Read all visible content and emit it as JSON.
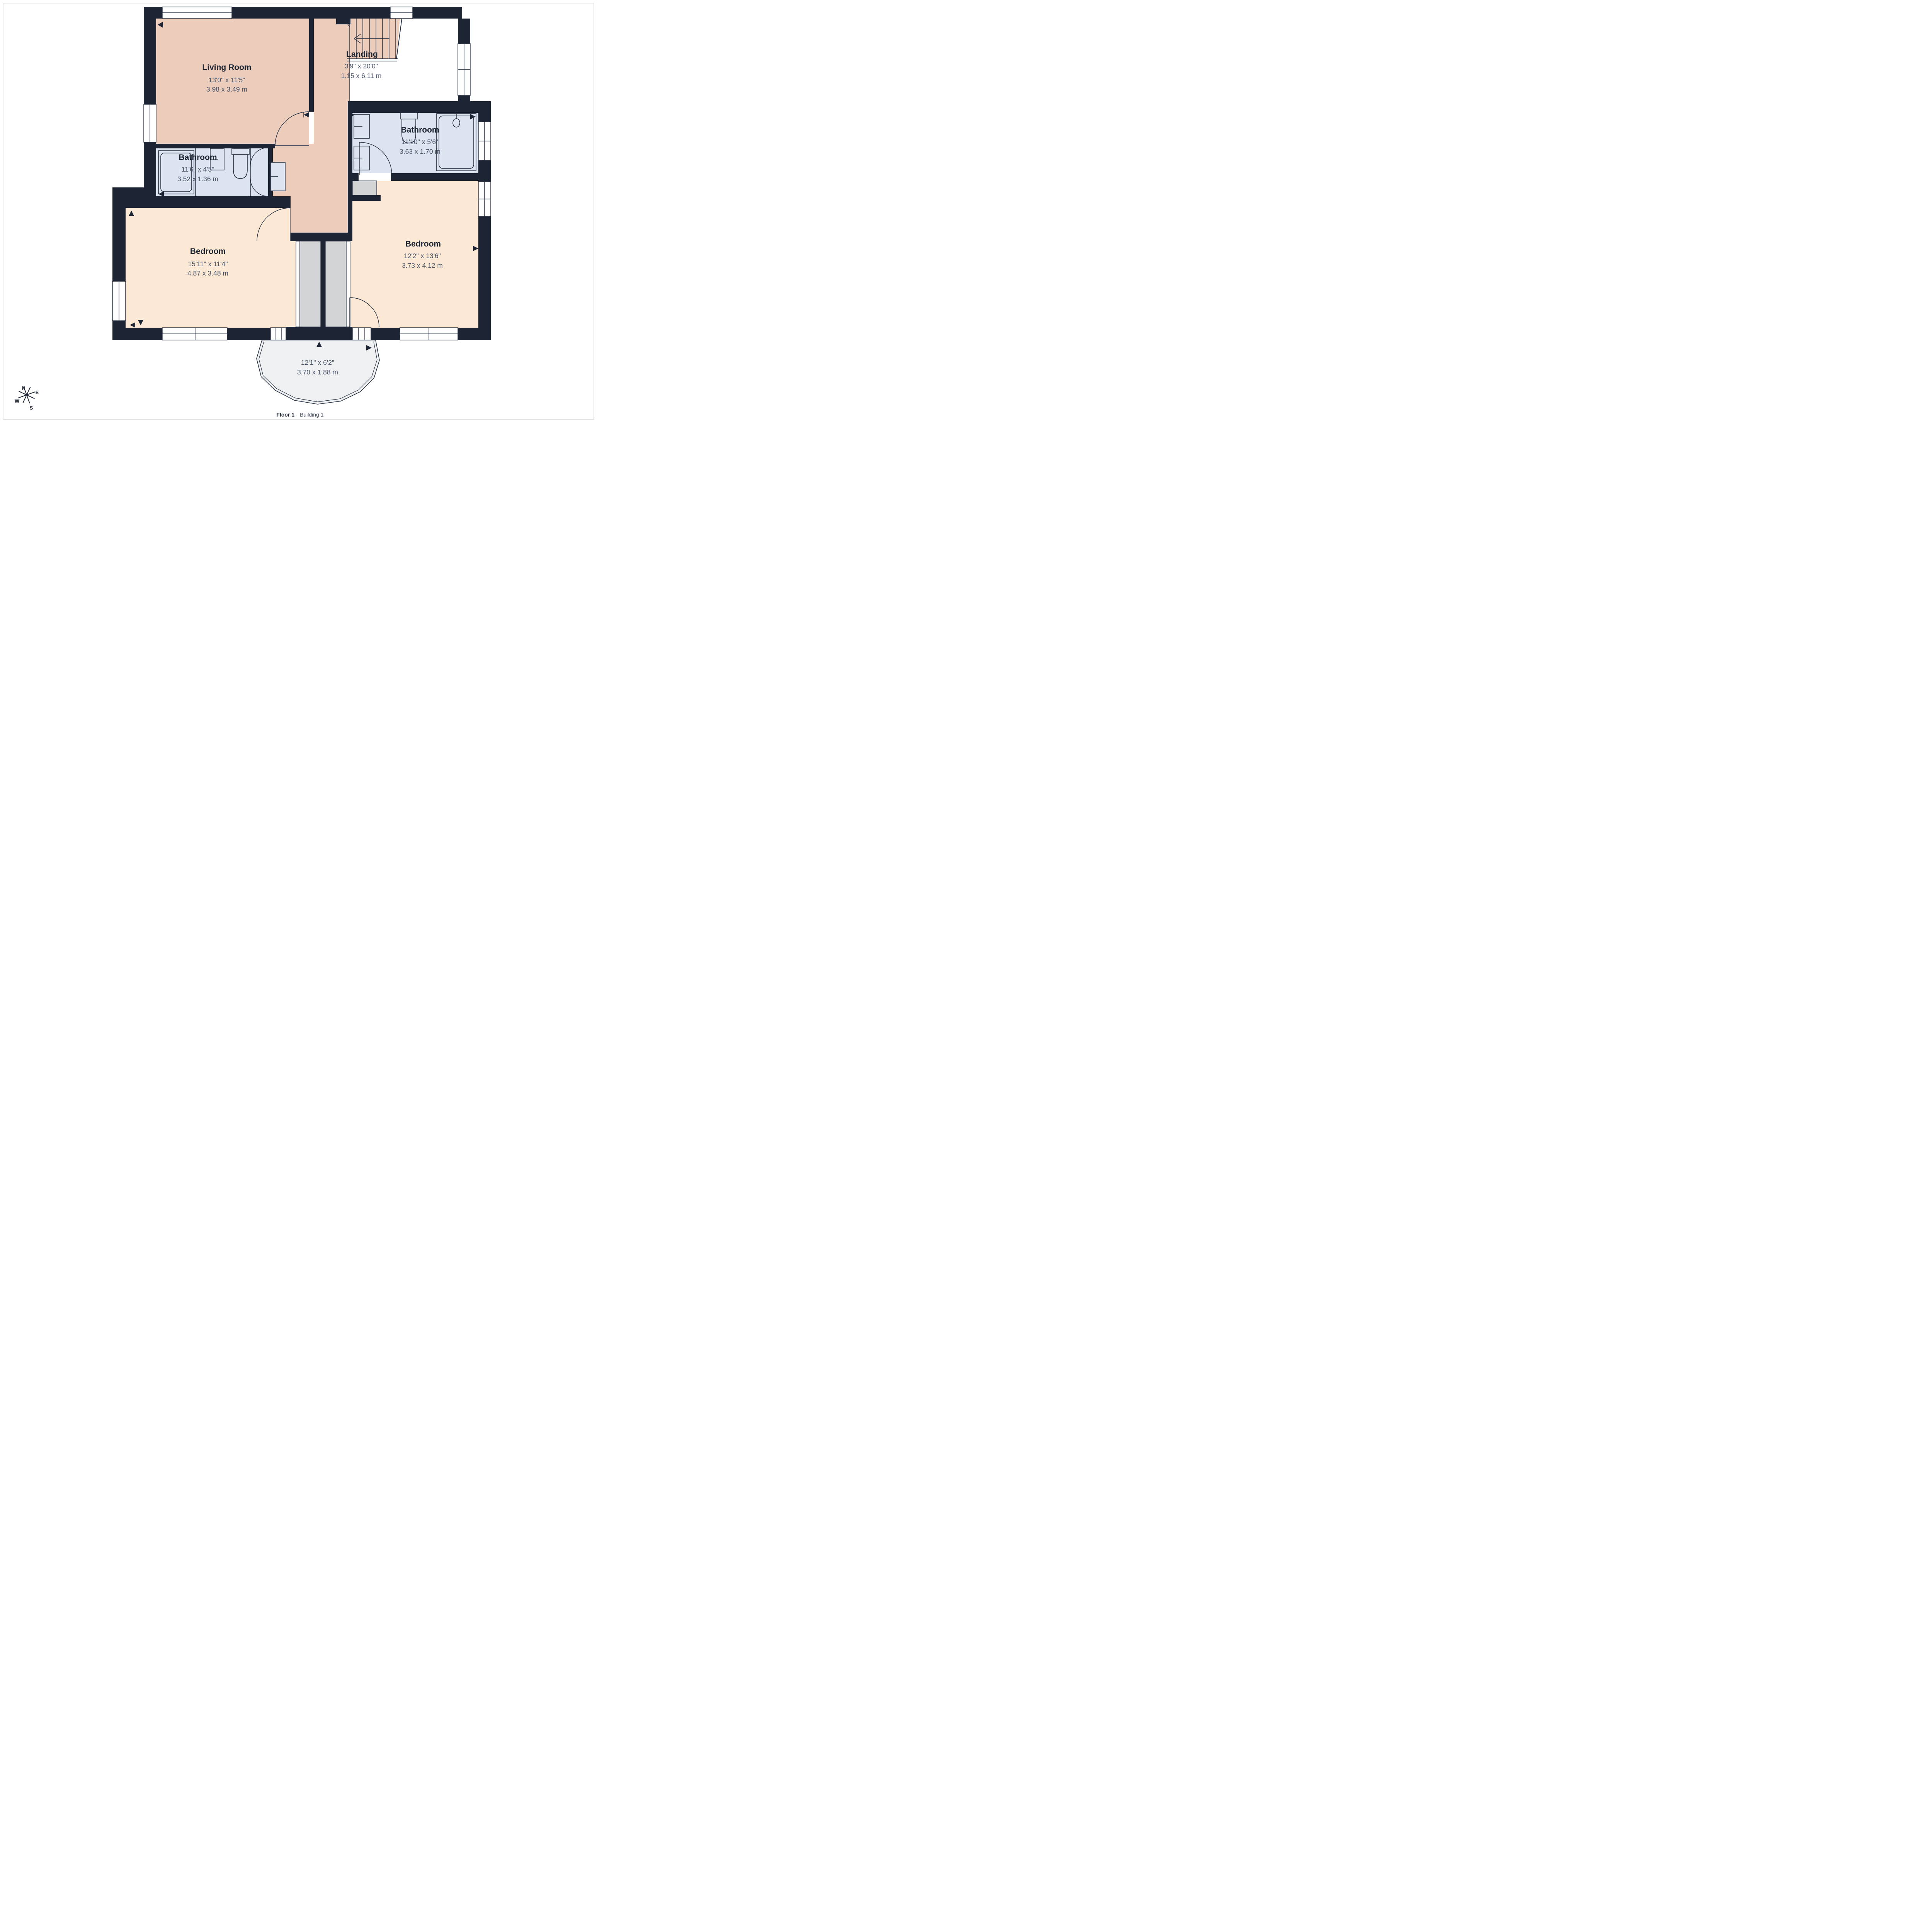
{
  "caption": {
    "floor": "Floor 1",
    "building": "Building 1"
  },
  "rooms": [
    {
      "name": "Living Room",
      "dims_imperial": "13'0\" x 11'5\"",
      "dims_metric": "3.98 x 3.49 m"
    },
    {
      "name": "Landing",
      "dims_imperial": "3'9\" x 20'0\"",
      "dims_metric": "1.15 x 6.11 m"
    },
    {
      "name": "Bathroom",
      "dims_imperial": "11'10\" x 5'6\"",
      "dims_metric": "3.63 x 1.70 m"
    },
    {
      "name": "Bathroom",
      "dims_imperial": "11'6\" x 4'5\"",
      "dims_metric": "3.52 x 1.36 m"
    },
    {
      "name": "Bedroom",
      "dims_imperial": "15'11\" x 11'4\"",
      "dims_metric": "4.87 x 3.48 m"
    },
    {
      "name": "Bedroom",
      "dims_imperial": "12'2\" x 13'6\"",
      "dims_metric": "3.73 x 4.12 m"
    },
    {
      "name": "Balcony",
      "dims_imperial": "12'1\" x 6'2\"",
      "dims_metric": "3.70 x 1.88 m"
    }
  ],
  "compass": {
    "n": "N",
    "e": "E",
    "s": "S",
    "w": "W"
  },
  "colors": {
    "wall": "#1d2433",
    "salmon": "#ecccbb",
    "peach": "#fbe9d6",
    "blue": "#dde3ef",
    "balcony": "#eef0f1",
    "gray": "#d3d4d6",
    "line": "#232d3f",
    "label": "#1f2633",
    "dim": "#4b5569",
    "page_border": "#d9d9d9"
  }
}
